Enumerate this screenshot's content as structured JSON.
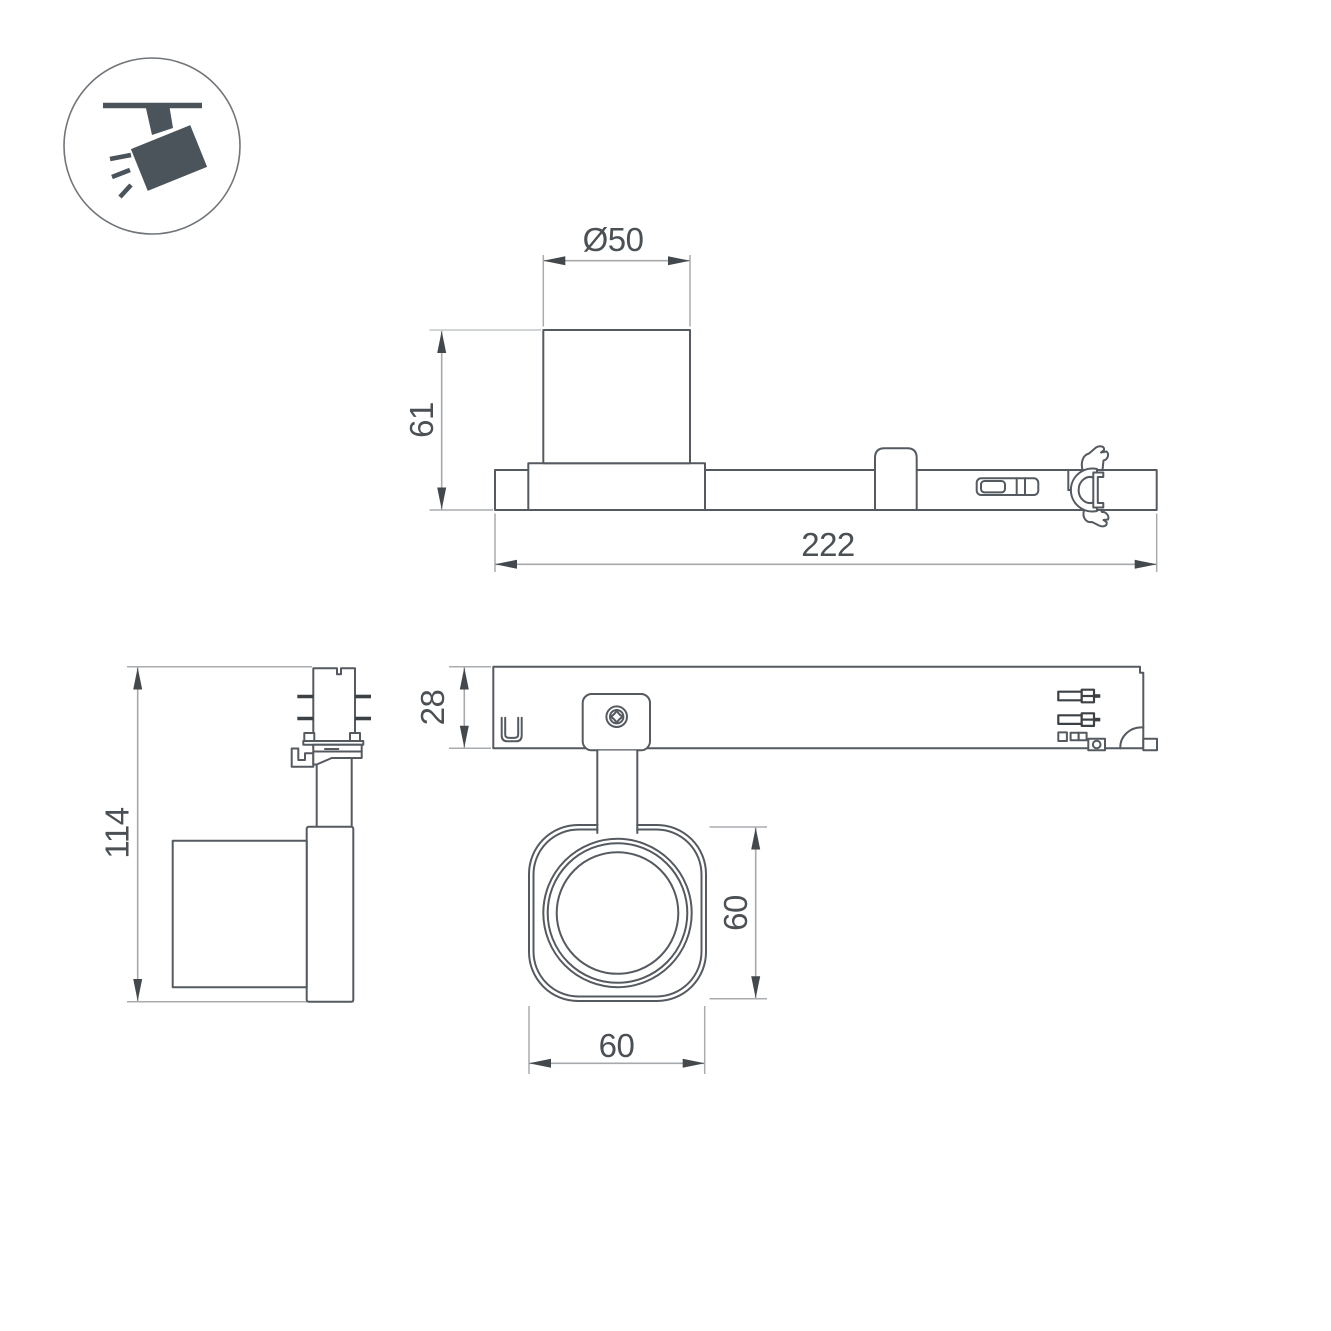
{
  "icon_badge": {
    "name": "ceiling-track-spotlight-pictogram",
    "fill": "#4c545b"
  },
  "dimensions": {
    "lamp_diameter": "Ø50",
    "lamp_height": "61",
    "track_length": "222",
    "fixture_height": "114",
    "track_depth": "28",
    "head_height": "60",
    "head_width": "60"
  },
  "colors": {
    "object_line": "#555a60",
    "dimension_line": "#a6aaad",
    "arrow": "#43484c",
    "text": "#4b5055",
    "icon_fill": "#4c545b",
    "background": "#ffffff"
  }
}
